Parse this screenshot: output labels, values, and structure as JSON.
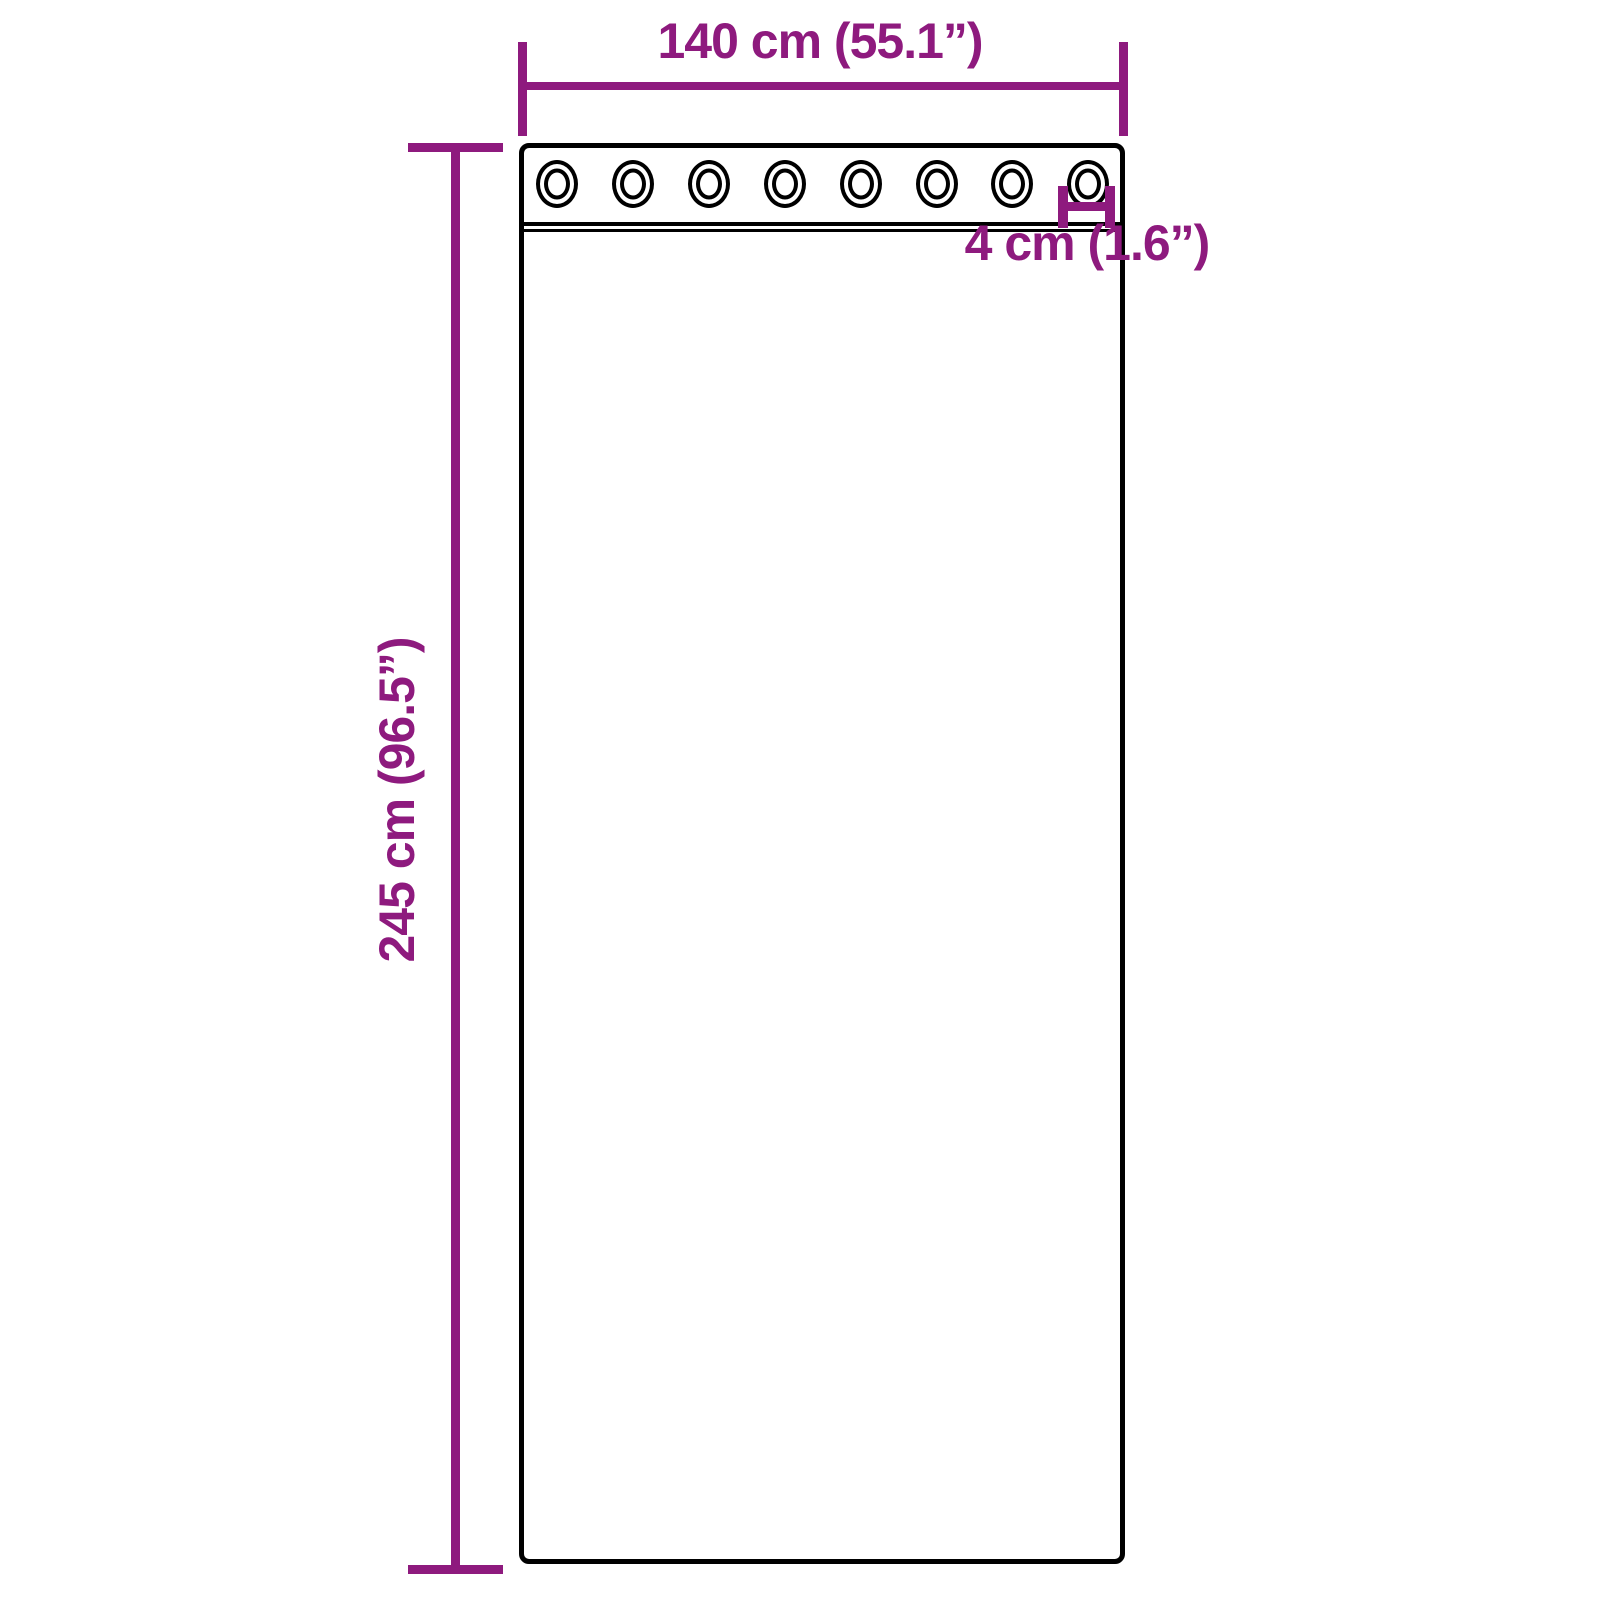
{
  "diagram": {
    "title": "Curtain with grommets dimension diagram",
    "grommet_count": 8,
    "colors": {
      "dimension": "#8E1A7E",
      "outline": "#000000",
      "background": "#FFFFFF"
    },
    "labels": {
      "width": "140 cm (55.1”)",
      "height": "245 cm (96.5”)",
      "grommet": "4 cm (1.6”)"
    }
  }
}
